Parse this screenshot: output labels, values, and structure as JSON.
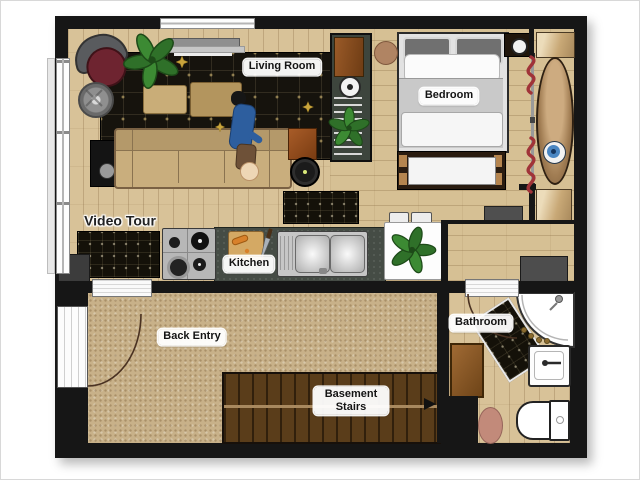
{
  "labels": {
    "living_room": "Living Room",
    "bedroom": "Bedroom",
    "kitchen": "Kitchen",
    "bathroom": "Bathroom",
    "back_entry": "Back Entry",
    "basement_stairs": "Basement Stairs",
    "video_tour": "Video Tour"
  },
  "colors": {
    "wall": "#161616",
    "wood_floor": "#d8c298",
    "carpet": "#c8b189",
    "area_rug": "#16130d",
    "counter": "#454c45",
    "sofa": "#c9ae7d",
    "stairs": "#5a3d1a",
    "bed_blanket": "#c9c9c9",
    "plant_green": "#2f7029",
    "clothes_red": "#a03338",
    "shirt_blue": "#2d5e9e",
    "eye_rug_blue": "#4a86c2"
  },
  "rooms": [
    {
      "name": "Living Room",
      "items": [
        "tv",
        "soundbar",
        "area-rug",
        "sectional-sofa",
        "coffee-table",
        "side-table",
        "armchair",
        "round-stool",
        "speaker-cabinet",
        "floor-plant",
        "robot-vacuum",
        "person",
        "cat"
      ]
    },
    {
      "name": "Bedroom",
      "items": [
        "double-bed",
        "foot-bench",
        "pouf",
        "speaker",
        "shelf-unit",
        "closet-sliding-door",
        "hanging-clothes",
        "oval-rug"
      ]
    },
    {
      "name": "Kitchen",
      "items": [
        "gas-stove",
        "countertop",
        "cutting-board",
        "knife",
        "double-sink",
        "dining-table",
        "chairs",
        "potted-plant",
        "floor-mat"
      ]
    },
    {
      "name": "Back Entry",
      "items": [
        "entry-door",
        "door-swing-arc",
        "carpet",
        "basement-stairs",
        "direction-arrow"
      ]
    },
    {
      "name": "Bathroom",
      "items": [
        "corner-shower",
        "bath-mat",
        "vanity-sink",
        "toilet",
        "wood-mat",
        "oval-rug",
        "door-swing-arc",
        "washer"
      ]
    }
  ]
}
